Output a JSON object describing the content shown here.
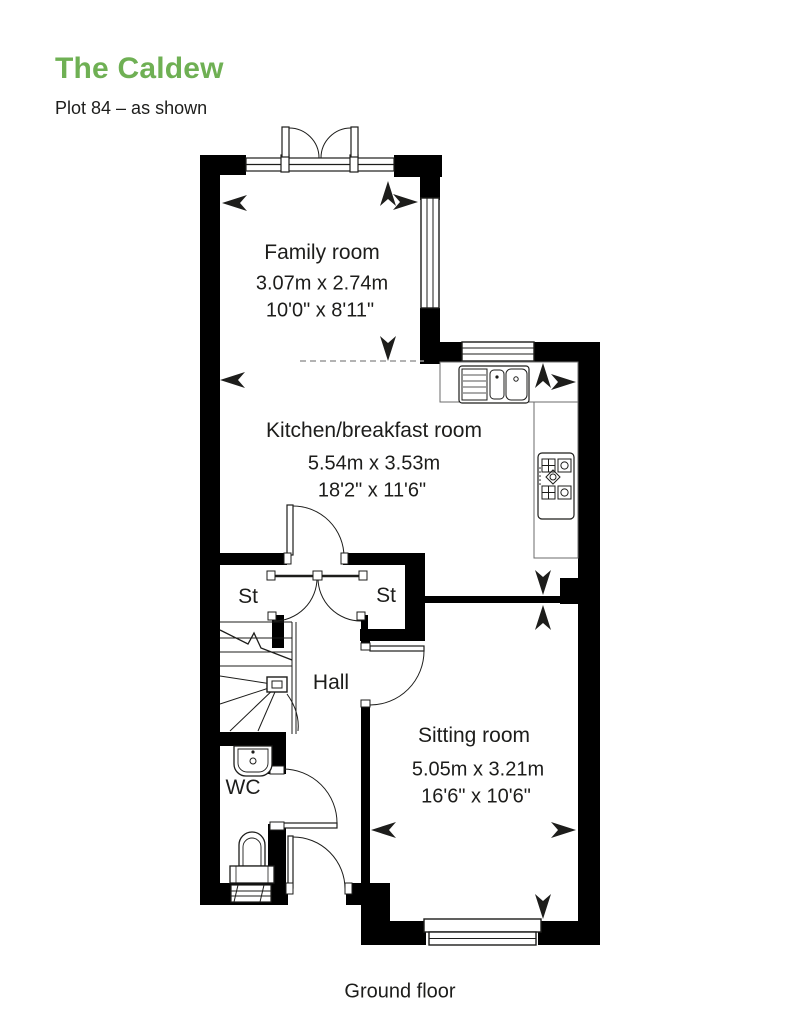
{
  "header": {
    "title": "The Caldew",
    "subtitle": "Plot 84 – as shown"
  },
  "rooms": {
    "family_room": {
      "name": "Family room",
      "metric": "3.07m x 2.74m",
      "imperial": "10'0\" x 8'11\""
    },
    "kitchen": {
      "name": "Kitchen/breakfast room",
      "metric": "5.54m x 3.53m",
      "imperial": "18'2\" x 11'6\""
    },
    "sitting_room": {
      "name": "Sitting room",
      "metric": "5.05m x 3.21m",
      "imperial": "16'6\" x 10'6\""
    },
    "hall": {
      "name": "Hall"
    },
    "wc": {
      "name": "WC"
    },
    "store_left": {
      "name": "St"
    },
    "store_right": {
      "name": "St"
    }
  },
  "footer": {
    "floor_label": "Ground floor"
  },
  "colors": {
    "accent_green": "#6fb054",
    "text": "#1d1d1b",
    "wall": "#000000"
  }
}
